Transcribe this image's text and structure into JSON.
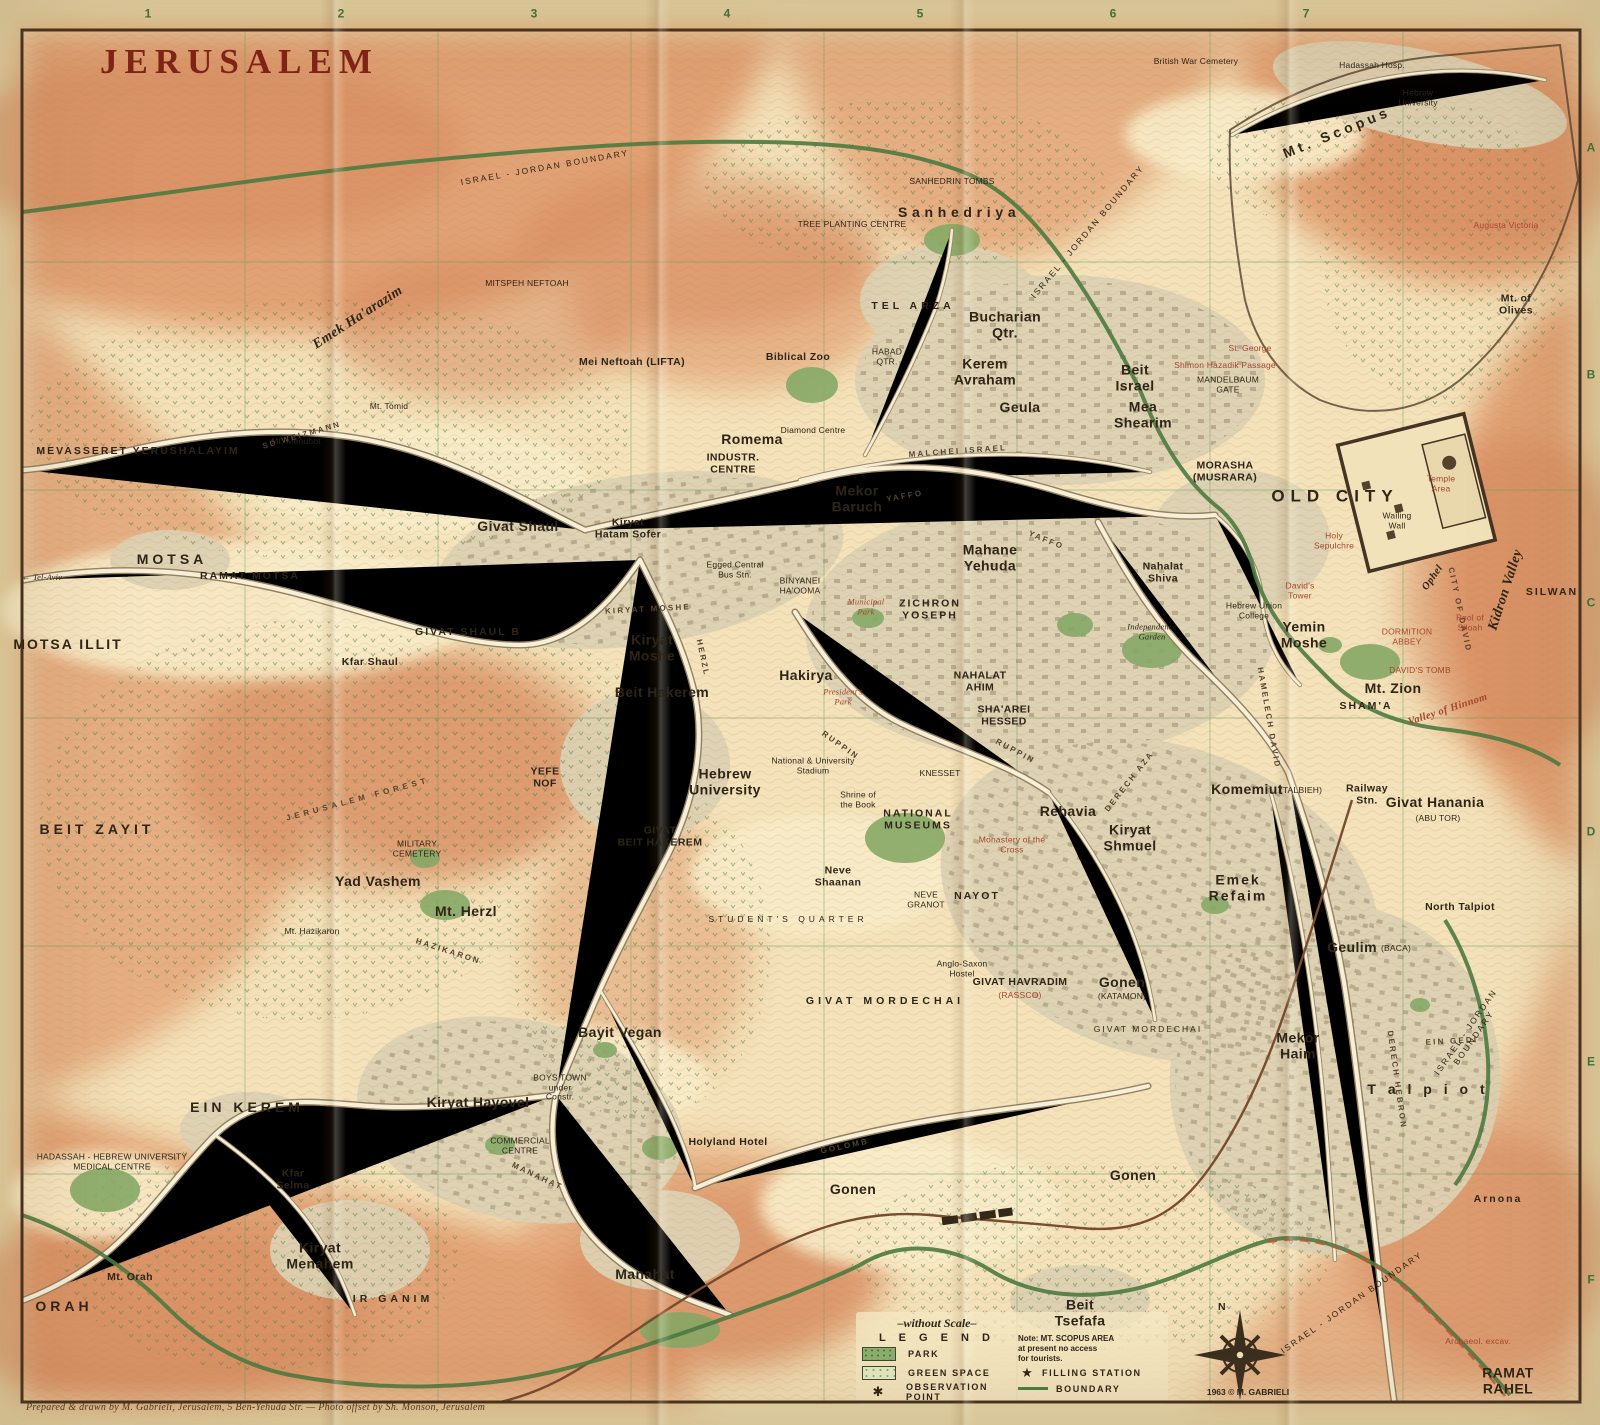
{
  "title": "JERUSALEM",
  "grid": {
    "columns": [
      {
        "t": "1",
        "x": 148,
        "y": 14
      },
      {
        "t": "2",
        "x": 341,
        "y": 14
      },
      {
        "t": "3",
        "x": 534,
        "y": 14
      },
      {
        "t": "4",
        "x": 727,
        "y": 14
      },
      {
        "t": "5",
        "x": 920,
        "y": 14
      },
      {
        "t": "6",
        "x": 1113,
        "y": 14
      },
      {
        "t": "7",
        "x": 1306,
        "y": 14
      }
    ],
    "rows": [
      {
        "t": "A",
        "x": 1591,
        "y": 148
      },
      {
        "t": "B",
        "x": 1591,
        "y": 375
      },
      {
        "t": "C",
        "x": 1591,
        "y": 603
      },
      {
        "t": "D",
        "x": 1591,
        "y": 832
      },
      {
        "t": "E",
        "x": 1591,
        "y": 1062
      },
      {
        "t": "F",
        "x": 1591,
        "y": 1280
      }
    ]
  },
  "legend": {
    "scale_note": "–without Scale–",
    "title": "L E G E N D",
    "items": [
      {
        "label": "PARK",
        "swatch": "park-swatch"
      },
      {
        "label": "GREEN SPACE",
        "swatch": "green-space-swatch"
      },
      {
        "label": "OBSERVATION POINT",
        "swatch": "asterisk",
        "symbol": "✱"
      },
      {
        "label": "FILLING STATION",
        "swatch": "star",
        "symbol": "★"
      },
      {
        "label": "BOUNDARY",
        "swatch": "line"
      }
    ],
    "note": "Note:  MT. SCOPUS AREA\nat present no access\nfor tourists."
  },
  "compass": {
    "north_label": "N"
  },
  "footer": {
    "copyright": "1963 © M. GABRIELI",
    "attribution": "Prepared & drawn by M. Gabrieli, Jerusalem, 5 Ben-Yehuda Str.  —  Photo offset by Sh. Monson, Jerusalem"
  },
  "map": {
    "labels": [
      {
        "t": "ISRAEL - JORDAN  BOUNDARY",
        "x": 545,
        "y": 168,
        "c": "sz-t sp1",
        "r": -10
      },
      {
        "t": "ISRAEL - JORDAN  BOUNDARY",
        "x": 1088,
        "y": 232,
        "c": "sz-t sp1",
        "r": -50
      },
      {
        "t": "ISRAEL - JORDAN  BOUNDARY",
        "x": 1470,
        "y": 1035,
        "c": "sz-t sp1",
        "r": -55
      },
      {
        "t": "ISRAEL - JORDAN  BOUNDARY",
        "x": 1352,
        "y": 1303,
        "c": "sz-t sp1",
        "r": -35
      },
      {
        "t": "British War Cemetery",
        "x": 1196,
        "y": 62,
        "c": "sz-t"
      },
      {
        "t": "Hadassah Hosp.",
        "x": 1372,
        "y": 66,
        "c": "sz-t"
      },
      {
        "t": "Hebrew\nUniversity",
        "x": 1418,
        "y": 98,
        "c": "sz-t"
      },
      {
        "t": "Mt. Scopus",
        "x": 1337,
        "y": 133,
        "c": "sz-m sp2",
        "r": -22
      },
      {
        "t": "Augusta Victoria",
        "x": 1506,
        "y": 226,
        "c": "sz-t red"
      },
      {
        "t": "Mt. of\nOlives",
        "x": 1516,
        "y": 305,
        "c": "sz-s"
      },
      {
        "t": "SANHEDRIN TOMBS",
        "x": 952,
        "y": 182,
        "c": "sz-t"
      },
      {
        "t": "S a n h e d r i y a",
        "x": 957,
        "y": 213,
        "c": "sz-m"
      },
      {
        "t": "TREE PLANTING CENTRE",
        "x": 852,
        "y": 225,
        "c": "sz-t"
      },
      {
        "t": "MITSPEH NEFTOAH",
        "x": 527,
        "y": 284,
        "c": "sz-t"
      },
      {
        "t": "Emek  Ha'arazim",
        "x": 358,
        "y": 318,
        "c": "sz-m it",
        "r": -33
      },
      {
        "t": "Mt. Tomid",
        "x": 389,
        "y": 407,
        "c": "sz-t"
      },
      {
        "t": "Mt. Menuhot",
        "x": 296,
        "y": 442,
        "c": "sz-t"
      },
      {
        "t": "MEVASSERET  YERUSHALAYIM",
        "x": 138,
        "y": 452,
        "c": "sz-s sp1"
      },
      {
        "t": "TEL  ARZA",
        "x": 913,
        "y": 307,
        "c": "sz-s sp2"
      },
      {
        "t": "Bucharian\nQtr.",
        "x": 1005,
        "y": 325,
        "c": "sz-m"
      },
      {
        "t": "HABAD\nQTR.",
        "x": 887,
        "y": 357,
        "c": "sz-t"
      },
      {
        "t": "Mei Neftoah (LIFTA)",
        "x": 632,
        "y": 363,
        "c": "sz-s"
      },
      {
        "t": "Biblical Zoo",
        "x": 798,
        "y": 358,
        "c": "sz-s"
      },
      {
        "t": "Kerem\nAvraham",
        "x": 985,
        "y": 372,
        "c": "sz-m"
      },
      {
        "t": "Beit\nIsrael",
        "x": 1135,
        "y": 378,
        "c": "sz-m"
      },
      {
        "t": "Geula",
        "x": 1020,
        "y": 408,
        "c": "sz-m"
      },
      {
        "t": "Mea\nShearim",
        "x": 1143,
        "y": 415,
        "c": "sz-m"
      },
      {
        "t": "Shimon Hazadik Passage",
        "x": 1225,
        "y": 366,
        "c": "sz-t red"
      },
      {
        "t": "MANDELBAUM\nGATE",
        "x": 1228,
        "y": 385,
        "c": "sz-t"
      },
      {
        "t": "St. George",
        "x": 1250,
        "y": 349,
        "c": "sz-t red"
      },
      {
        "t": "Romema",
        "x": 752,
        "y": 440,
        "c": "sz-m"
      },
      {
        "t": "INDUSTR.\nCENTRE",
        "x": 733,
        "y": 464,
        "c": "sz-s"
      },
      {
        "t": "Diamond Centre",
        "x": 813,
        "y": 431,
        "c": "sz-t"
      },
      {
        "t": "Mekor\nBaruch",
        "x": 857,
        "y": 499,
        "c": "sz-m"
      },
      {
        "t": "MALCHEI  ISRAEL",
        "x": 958,
        "y": 452,
        "c": "road",
        "r": -4
      },
      {
        "t": "YAFFO",
        "x": 905,
        "y": 497,
        "c": "road",
        "r": -10
      },
      {
        "t": "YAFFO",
        "x": 1046,
        "y": 541,
        "c": "road",
        "r": 22
      },
      {
        "t": "SD  WEIZMANN",
        "x": 302,
        "y": 436,
        "c": "road",
        "r": -16
      },
      {
        "t": "MORASHA\n(MUSRARA)",
        "x": 1225,
        "y": 472,
        "c": "sz-s"
      },
      {
        "t": "OLD  CITY",
        "x": 1335,
        "y": 496,
        "c": "sz-l"
      },
      {
        "t": "Temple\nArea",
        "x": 1441,
        "y": 484,
        "c": "sz-t red"
      },
      {
        "t": "Wailing\nWall",
        "x": 1397,
        "y": 521,
        "c": "sz-t"
      },
      {
        "t": "Holy\nSepulchre",
        "x": 1334,
        "y": 541,
        "c": "sz-t red"
      },
      {
        "t": "David's\nTower",
        "x": 1300,
        "y": 591,
        "c": "sz-t red"
      },
      {
        "t": "Givat Shaul",
        "x": 518,
        "y": 527,
        "c": "sz-m"
      },
      {
        "t": "Kiryat\nHatam Sofer",
        "x": 628,
        "y": 529,
        "c": "sz-s"
      },
      {
        "t": "GIVAT  SHAUL  B",
        "x": 468,
        "y": 633,
        "c": "sz-s sp1"
      },
      {
        "t": "Kfar Shaul",
        "x": 370,
        "y": 663,
        "c": "sz-s"
      },
      {
        "t": "KIRYAT  MOSHE",
        "x": 648,
        "y": 610,
        "c": "road",
        "r": -3
      },
      {
        "t": "Kiryat\nMoshe",
        "x": 652,
        "y": 648,
        "c": "sz-m"
      },
      {
        "t": "HERZL",
        "x": 702,
        "y": 658,
        "c": "road",
        "r": 78
      },
      {
        "t": "Mahane\nYehuda",
        "x": 990,
        "y": 558,
        "c": "sz-m"
      },
      {
        "t": "ZICHRON\nYOSEPH",
        "x": 930,
        "y": 610,
        "c": "sz-s sp1"
      },
      {
        "t": "Nahalat\nShiva",
        "x": 1163,
        "y": 573,
        "c": "sz-s"
      },
      {
        "t": "BINYANEI\nHA'OOMA",
        "x": 800,
        "y": 586,
        "c": "sz-t"
      },
      {
        "t": "Egged Central\nBus Stn.",
        "x": 735,
        "y": 570,
        "c": "sz-t"
      },
      {
        "t": "Municipal\nPark",
        "x": 866,
        "y": 607,
        "c": "sz-t red it"
      },
      {
        "t": "Independence\nGarden",
        "x": 1152,
        "y": 632,
        "c": "sz-t it"
      },
      {
        "t": "Hebrew Union\nCollege",
        "x": 1254,
        "y": 611,
        "c": "sz-t"
      },
      {
        "t": "Yemin\nMoshe",
        "x": 1304,
        "y": 635,
        "c": "sz-m"
      },
      {
        "t": "NAHALAT\nAHIM",
        "x": 980,
        "y": 682,
        "c": "sz-s"
      },
      {
        "t": "SHA'AREI\nHESSED",
        "x": 1004,
        "y": 716,
        "c": "sz-s"
      },
      {
        "t": "Hakirya",
        "x": 806,
        "y": 676,
        "c": "sz-m"
      },
      {
        "t": "President's\nPark",
        "x": 843,
        "y": 697,
        "c": "sz-t red it"
      },
      {
        "t": "Mt. Zion",
        "x": 1393,
        "y": 689,
        "c": "sz-m"
      },
      {
        "t": "DAVID'S TOMB",
        "x": 1420,
        "y": 671,
        "c": "sz-t red"
      },
      {
        "t": "DORMITION\nABBEY",
        "x": 1407,
        "y": 637,
        "c": "sz-t red"
      },
      {
        "t": "SHAM'A",
        "x": 1366,
        "y": 707,
        "c": "sz-s sp1"
      },
      {
        "t": "Valley of Hinnom",
        "x": 1448,
        "y": 710,
        "c": "sz-s it red",
        "r": -18
      },
      {
        "t": "Ophel",
        "x": 1433,
        "y": 578,
        "c": "sz-s it",
        "r": -55
      },
      {
        "t": "CITY OF DAVID",
        "x": 1459,
        "y": 610,
        "c": "road",
        "r": 78
      },
      {
        "t": "Kidron Valley",
        "x": 1506,
        "y": 590,
        "c": "sz-m it",
        "r": -72
      },
      {
        "t": "SILWAN",
        "x": 1552,
        "y": 593,
        "c": "sz-s sp1"
      },
      {
        "t": "Pool of\nSiloah",
        "x": 1470,
        "y": 623,
        "c": "sz-t red"
      },
      {
        "t": "Beit Hakerem",
        "x": 662,
        "y": 693,
        "c": "sz-m"
      },
      {
        "t": "YEFE\nNOF",
        "x": 545,
        "y": 778,
        "c": "sz-s"
      },
      {
        "t": "Hebrew\nUniversity",
        "x": 725,
        "y": 782,
        "c": "sz-m"
      },
      {
        "t": "National & University\nStadium",
        "x": 813,
        "y": 766,
        "c": "sz-t"
      },
      {
        "t": "GIVAT\nBEIT HAKEREM",
        "x": 660,
        "y": 837,
        "c": "sz-s"
      },
      {
        "t": "KNESSET",
        "x": 940,
        "y": 774,
        "c": "sz-t"
      },
      {
        "t": "Shrine of\nthe Book",
        "x": 858,
        "y": 800,
        "c": "sz-t"
      },
      {
        "t": "NATIONAL\nMUSEUMS",
        "x": 918,
        "y": 820,
        "c": "sz-s sp1"
      },
      {
        "t": "Neve\nShaanan",
        "x": 838,
        "y": 877,
        "c": "sz-s"
      },
      {
        "t": "NEVE\nGRANOT",
        "x": 926,
        "y": 900,
        "c": "sz-t"
      },
      {
        "t": "NAYOT",
        "x": 977,
        "y": 897,
        "c": "sz-s sp1"
      },
      {
        "t": "STUDENT'S  QUARTER",
        "x": 788,
        "y": 920,
        "c": "sz-t sp2"
      },
      {
        "t": "Monastery of the\nCross",
        "x": 1012,
        "y": 845,
        "c": "sz-t red"
      },
      {
        "t": "Rehavia",
        "x": 1068,
        "y": 812,
        "c": "sz-m"
      },
      {
        "t": "RUPPIN",
        "x": 840,
        "y": 746,
        "c": "road",
        "r": 35
      },
      {
        "t": "RUPPIN",
        "x": 1015,
        "y": 752,
        "c": "road",
        "r": 28
      },
      {
        "t": "DERECH  AZA",
        "x": 1130,
        "y": 782,
        "c": "road",
        "r": -52
      },
      {
        "t": "Kiryat\nShmuel",
        "x": 1130,
        "y": 838,
        "c": "sz-m"
      },
      {
        "t": "Komemiut",
        "x": 1247,
        "y": 790,
        "c": "sz-m"
      },
      {
        "t": "(TALBIEH)",
        "x": 1301,
        "y": 791,
        "c": "sz-t"
      },
      {
        "t": "Railway\nStn.",
        "x": 1367,
        "y": 795,
        "c": "sz-s"
      },
      {
        "t": "Givat Hanania",
        "x": 1435,
        "y": 803,
        "c": "sz-m"
      },
      {
        "t": "(ABU TOR)",
        "x": 1438,
        "y": 819,
        "c": "sz-t"
      },
      {
        "t": "HAMELECH  DAVID",
        "x": 1268,
        "y": 718,
        "c": "road",
        "r": 80
      },
      {
        "t": "Emek\nRefaim",
        "x": 1238,
        "y": 888,
        "c": "sz-m sp1"
      },
      {
        "t": "North Talpiot",
        "x": 1460,
        "y": 908,
        "c": "sz-s"
      },
      {
        "t": "Geulim",
        "x": 1352,
        "y": 948,
        "c": "sz-m"
      },
      {
        "t": "(BACA)",
        "x": 1396,
        "y": 949,
        "c": "sz-t"
      },
      {
        "t": "GIVAT HAVRADIM",
        "x": 1020,
        "y": 983,
        "c": "sz-s"
      },
      {
        "t": "(RASSCO)",
        "x": 1020,
        "y": 996,
        "c": "sz-t red"
      },
      {
        "t": "Anglo-Saxon\nHostel",
        "x": 962,
        "y": 969,
        "c": "sz-t"
      },
      {
        "t": "Gonen",
        "x": 1122,
        "y": 983,
        "c": "sz-m"
      },
      {
        "t": "(KATAMON)",
        "x": 1122,
        "y": 997,
        "c": "sz-t"
      },
      {
        "t": "GIVAT  MORDECHAI",
        "x": 885,
        "y": 1002,
        "c": "sz-s sp2"
      },
      {
        "t": "Bayit Vegan",
        "x": 620,
        "y": 1033,
        "c": "sz-m"
      },
      {
        "t": "BOYS TOWN\nunder\nConstr.",
        "x": 560,
        "y": 1088,
        "c": "sz-t"
      },
      {
        "t": "Kiryat Hayovel",
        "x": 478,
        "y": 1103,
        "c": "sz-m"
      },
      {
        "t": "COMMERCIAL\nCENTRE",
        "x": 520,
        "y": 1146,
        "c": "sz-t"
      },
      {
        "t": "Holyland Hotel",
        "x": 728,
        "y": 1143,
        "c": "sz-s"
      },
      {
        "t": "GOLOMB",
        "x": 845,
        "y": 1147,
        "c": "road",
        "r": -12
      },
      {
        "t": "Gonen",
        "x": 853,
        "y": 1190,
        "c": "sz-m"
      },
      {
        "t": "Gonen",
        "x": 1133,
        "y": 1176,
        "c": "sz-m"
      },
      {
        "t": "MANAHAT",
        "x": 537,
        "y": 1177,
        "c": "road",
        "r": 25
      },
      {
        "t": "Manahat",
        "x": 645,
        "y": 1275,
        "c": "sz-m"
      },
      {
        "t": "EIN  KEREM",
        "x": 247,
        "y": 1108,
        "c": "sz-m sp2"
      },
      {
        "t": "HADASSAH - HEBREW UNIVERSITY\nMEDICAL CENTRE",
        "x": 112,
        "y": 1162,
        "c": "sz-t"
      },
      {
        "t": "Kfar\nSelma",
        "x": 293,
        "y": 1180,
        "c": "sz-s"
      },
      {
        "t": "Kiryat\nMenahem",
        "x": 320,
        "y": 1256,
        "c": "sz-m"
      },
      {
        "t": "IR  GANIM",
        "x": 393,
        "y": 1300,
        "c": "sz-s sp2"
      },
      {
        "t": "Mt. Orah",
        "x": 130,
        "y": 1278,
        "c": "sz-s"
      },
      {
        "t": "ORAH",
        "x": 64,
        "y": 1307,
        "c": "sz-m sp2"
      },
      {
        "t": "BEIT   ZAYIT",
        "x": 97,
        "y": 830,
        "c": "sz-m sp2"
      },
      {
        "t": "JERUSALEM  FOREST",
        "x": 358,
        "y": 800,
        "c": "road sp2",
        "r": -15
      },
      {
        "t": "MILITARY\nCEMETERY",
        "x": 417,
        "y": 849,
        "c": "sz-t"
      },
      {
        "t": "Yad Vashem",
        "x": 378,
        "y": 882,
        "c": "sz-m"
      },
      {
        "t": "Mt. Herzl",
        "x": 466,
        "y": 912,
        "c": "sz-m"
      },
      {
        "t": "Mt. Hazikaron",
        "x": 312,
        "y": 932,
        "c": "sz-t"
      },
      {
        "t": "HAZIKARON",
        "x": 448,
        "y": 952,
        "c": "road",
        "r": 18
      },
      {
        "t": "MOTSA",
        "x": 172,
        "y": 560,
        "c": "sz-m sp2"
      },
      {
        "t": "RAMAT  MOTSA",
        "x": 250,
        "y": 577,
        "c": "sz-s sp1"
      },
      {
        "t": "MOTSA  ILLIT",
        "x": 68,
        "y": 645,
        "c": "sz-m sp1"
      },
      {
        "t": "← Tel-Aviv",
        "x": 42,
        "y": 578,
        "c": "sz-t it"
      },
      {
        "t": "Beit\nTsefafa",
        "x": 1080,
        "y": 1313,
        "c": "sz-m"
      },
      {
        "t": "Mekor\nHaim",
        "x": 1298,
        "y": 1046,
        "c": "sz-m"
      },
      {
        "t": "T a l p i o t",
        "x": 1428,
        "y": 1090,
        "c": "sz-m sp2"
      },
      {
        "t": "EIN GEDI",
        "x": 1452,
        "y": 1042,
        "c": "road",
        "r": -3
      },
      {
        "t": "DERECH  HEBRON",
        "x": 1396,
        "y": 1080,
        "c": "road",
        "r": 82
      },
      {
        "t": "Arnona",
        "x": 1498,
        "y": 1200,
        "c": "sz-s sp1"
      },
      {
        "t": "Archaeol. excav.",
        "x": 1478,
        "y": 1342,
        "c": "sz-t red"
      },
      {
        "t": "RAMAT RAHEL",
        "x": 1508,
        "y": 1381,
        "c": "sz-m"
      },
      {
        "t": "GIVAT MORDECHAI",
        "x": 1148,
        "y": 1030,
        "c": "sz-t sp1"
      }
    ]
  }
}
